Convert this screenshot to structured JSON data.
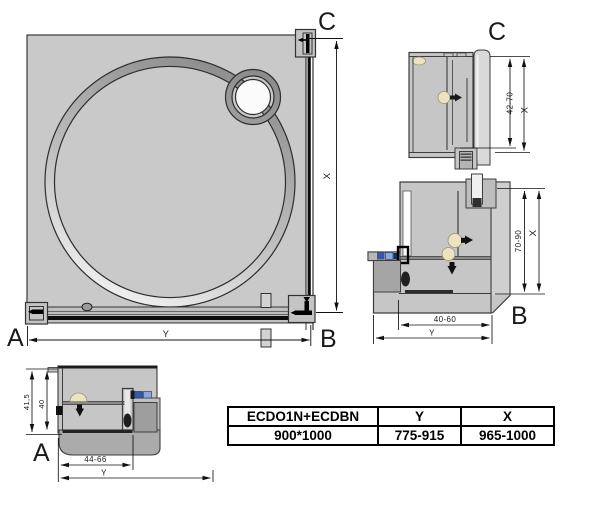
{
  "drawing": {
    "main_view": {
      "corner_a": "A",
      "corner_b": "B",
      "corner_c": "C",
      "dim_x": "X",
      "dim_y": "Y"
    },
    "detail_c": {
      "title": "C",
      "dim_range": "42-70",
      "dim_total": "X"
    },
    "detail_b": {
      "title": "B",
      "dim_v_range": "70-90",
      "dim_v_total": "X",
      "dim_h_range": "40-60",
      "dim_h_total": "Y"
    },
    "detail_a": {
      "title": "A",
      "dim_h_total": "41,5",
      "dim_h_inner": "40",
      "dim_w_range": "44-66",
      "dim_w_total": "Y"
    }
  },
  "spec_table": {
    "headers": [
      "ECDO1N+ECDBN",
      "Y",
      "X"
    ],
    "rows": [
      [
        "900*1000",
        "775-915",
        "965-1000"
      ]
    ]
  },
  "colors": {
    "panel_fill": "#c9c9c9",
    "line": "#2e2e2e",
    "accent_blue": "#3a57a7",
    "accent_blue_light": "#8fa5d3",
    "gasket_cream": "#ece3c1"
  }
}
